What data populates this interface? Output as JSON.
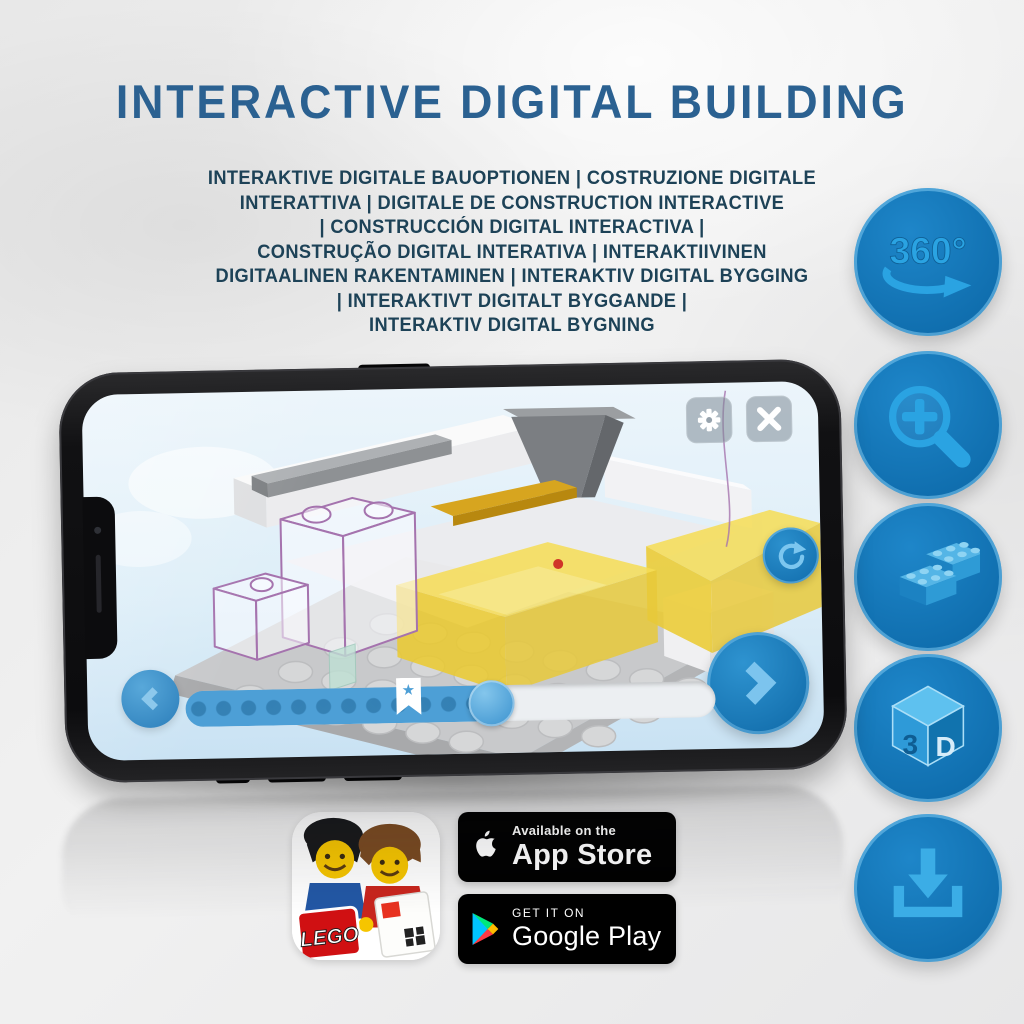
{
  "colors": {
    "accent_blue": "#1478bb",
    "glyph_blue": "#2aa3e2",
    "title_blue": "#2b6191",
    "subtitle_navy": "#1d4257",
    "slider_blue": "#4d9fd6",
    "yellow_brick": "#f0d440",
    "ghost_outline_purple": "#a573ae"
  },
  "header": {
    "title": "INTERACTIVE DIGITAL BUILDING"
  },
  "subtitle": {
    "lines": [
      "INTERAKTIVE DIGITALE BAUOPTIONEN | COSTRUZIONE DIGITALE",
      "INTERATTIVA | DIGITALE DE CONSTRUCTION INTERACTIVE",
      "| CONSTRUCCIÓN DIGITAL INTERACTIVA |",
      "CONSTRUÇÃO DIGITAL INTERATIVA | INTERAKTIIVINEN",
      "DIGITAALINEN RAKENTAMINEN | INTERAKTIV DIGITAL BYGGING",
      "| INTERAKTIVT DIGITALT BYGGANDE |",
      "INTERAKTIV DIGITAL BYGNING"
    ]
  },
  "features": {
    "rotate_label": "360°",
    "cube_left": "3",
    "cube_right": "D",
    "icons": [
      "360-rotation-icon",
      "zoom-in-icon",
      "brick-icon",
      "3d-cube-icon",
      "download-icon"
    ]
  },
  "phone": {
    "app_ui_icons": [
      "gear-icon",
      "close-icon",
      "rotate-reset-icon",
      "chevron-left-icon",
      "chevron-right-icon",
      "bookmark-star-icon"
    ],
    "slider": {
      "progress_percent": 58,
      "bookmark_percent": 42
    }
  },
  "store": {
    "app_icon_logo": "LEGO",
    "app_store": {
      "tagline": "Available on the",
      "name": "App Store"
    },
    "google_play": {
      "tagline": "GET IT ON",
      "name": "Google Play"
    }
  }
}
